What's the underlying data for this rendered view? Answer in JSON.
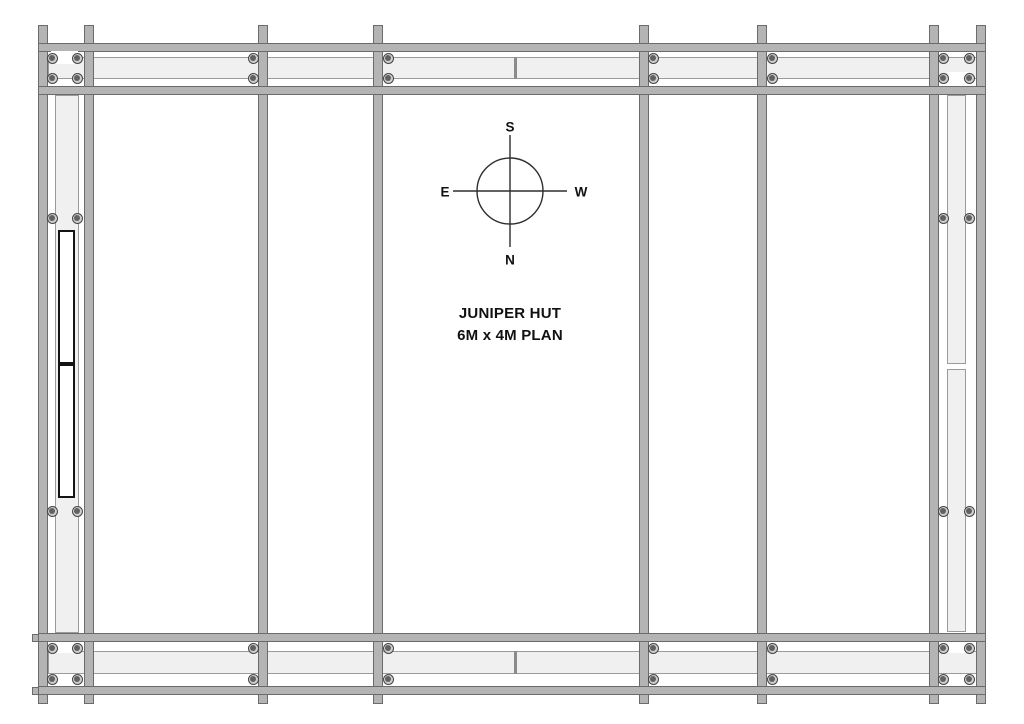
{
  "title": {
    "line1": "JUNIPER HUT",
    "line2": "6M x 4M PLAN"
  },
  "compass": {
    "cx": 510,
    "cy": 191,
    "radius": 33,
    "arm_v": 56,
    "arm_h": 57,
    "labels": {
      "top": "S",
      "bottom": "N",
      "left": "E",
      "right": "W"
    }
  },
  "colors": {
    "background": "#ffffff",
    "member_fill": "#b4b4b4",
    "member_stroke": "#6b6b6b",
    "panel_fill": "#f0f0f0",
    "panel_stroke": "#9b9b9b",
    "seam": "#8b8b8b",
    "door_fill": "#ffffff",
    "door_stroke": "#141414",
    "screw_ring": "#cfcfcf",
    "screw_stroke": "#454545",
    "screw_dot": "#616161",
    "compass_stroke": "#2e2e2e",
    "text": "#111111"
  },
  "plan": {
    "canvas": {
      "width": 1024,
      "height": 724
    },
    "posts": [
      [
        38,
        25,
        10,
        679
      ],
      [
        84,
        25,
        10,
        679
      ],
      [
        258,
        25,
        10,
        679
      ],
      [
        373,
        25,
        10,
        679
      ],
      [
        639,
        25,
        10,
        679
      ],
      [
        757,
        25,
        10,
        679
      ],
      [
        929,
        25,
        10,
        679
      ],
      [
        976,
        25,
        10,
        679
      ]
    ],
    "rails": [
      [
        38,
        43,
        948,
        9
      ],
      [
        38,
        86,
        948,
        9
      ],
      [
        38,
        633,
        948,
        9
      ],
      [
        38,
        686,
        948,
        9
      ]
    ],
    "panels": [
      [
        48,
        57,
        929,
        22
      ],
      [
        48,
        651,
        929,
        23
      ],
      [
        55,
        95,
        24,
        538
      ],
      [
        947,
        95,
        19,
        269
      ],
      [
        947,
        369,
        19,
        263
      ]
    ],
    "seams": [
      [
        514,
        57,
        3,
        22
      ],
      [
        514,
        651,
        3,
        23
      ]
    ],
    "door_panels": [
      [
        58,
        230,
        17,
        134
      ],
      [
        58,
        364,
        17,
        134
      ]
    ],
    "plates": [
      [
        51,
        51,
        27,
        13
      ],
      [
        948,
        72,
        20,
        12
      ],
      [
        56,
        642,
        22,
        11
      ],
      [
        948,
        642,
        19,
        11
      ]
    ],
    "nubs": [
      [
        32,
        634,
        7,
        8
      ],
      [
        32,
        687,
        7,
        8
      ]
    ],
    "screws": {
      "top_band": {
        "ys": [
          58,
          78
        ],
        "xs": [
          52,
          77,
          253,
          388,
          653,
          772,
          943,
          969
        ]
      },
      "bottom_band": {
        "ys": [
          648,
          679
        ],
        "xs": [
          52,
          77,
          253,
          388,
          653,
          772,
          943,
          969
        ]
      },
      "left_wall": {
        "ys": [
          218,
          511
        ],
        "xs": [
          52,
          77
        ]
      },
      "right_wall": {
        "ys": [
          218,
          511
        ],
        "xs": [
          943,
          969
        ]
      }
    }
  }
}
